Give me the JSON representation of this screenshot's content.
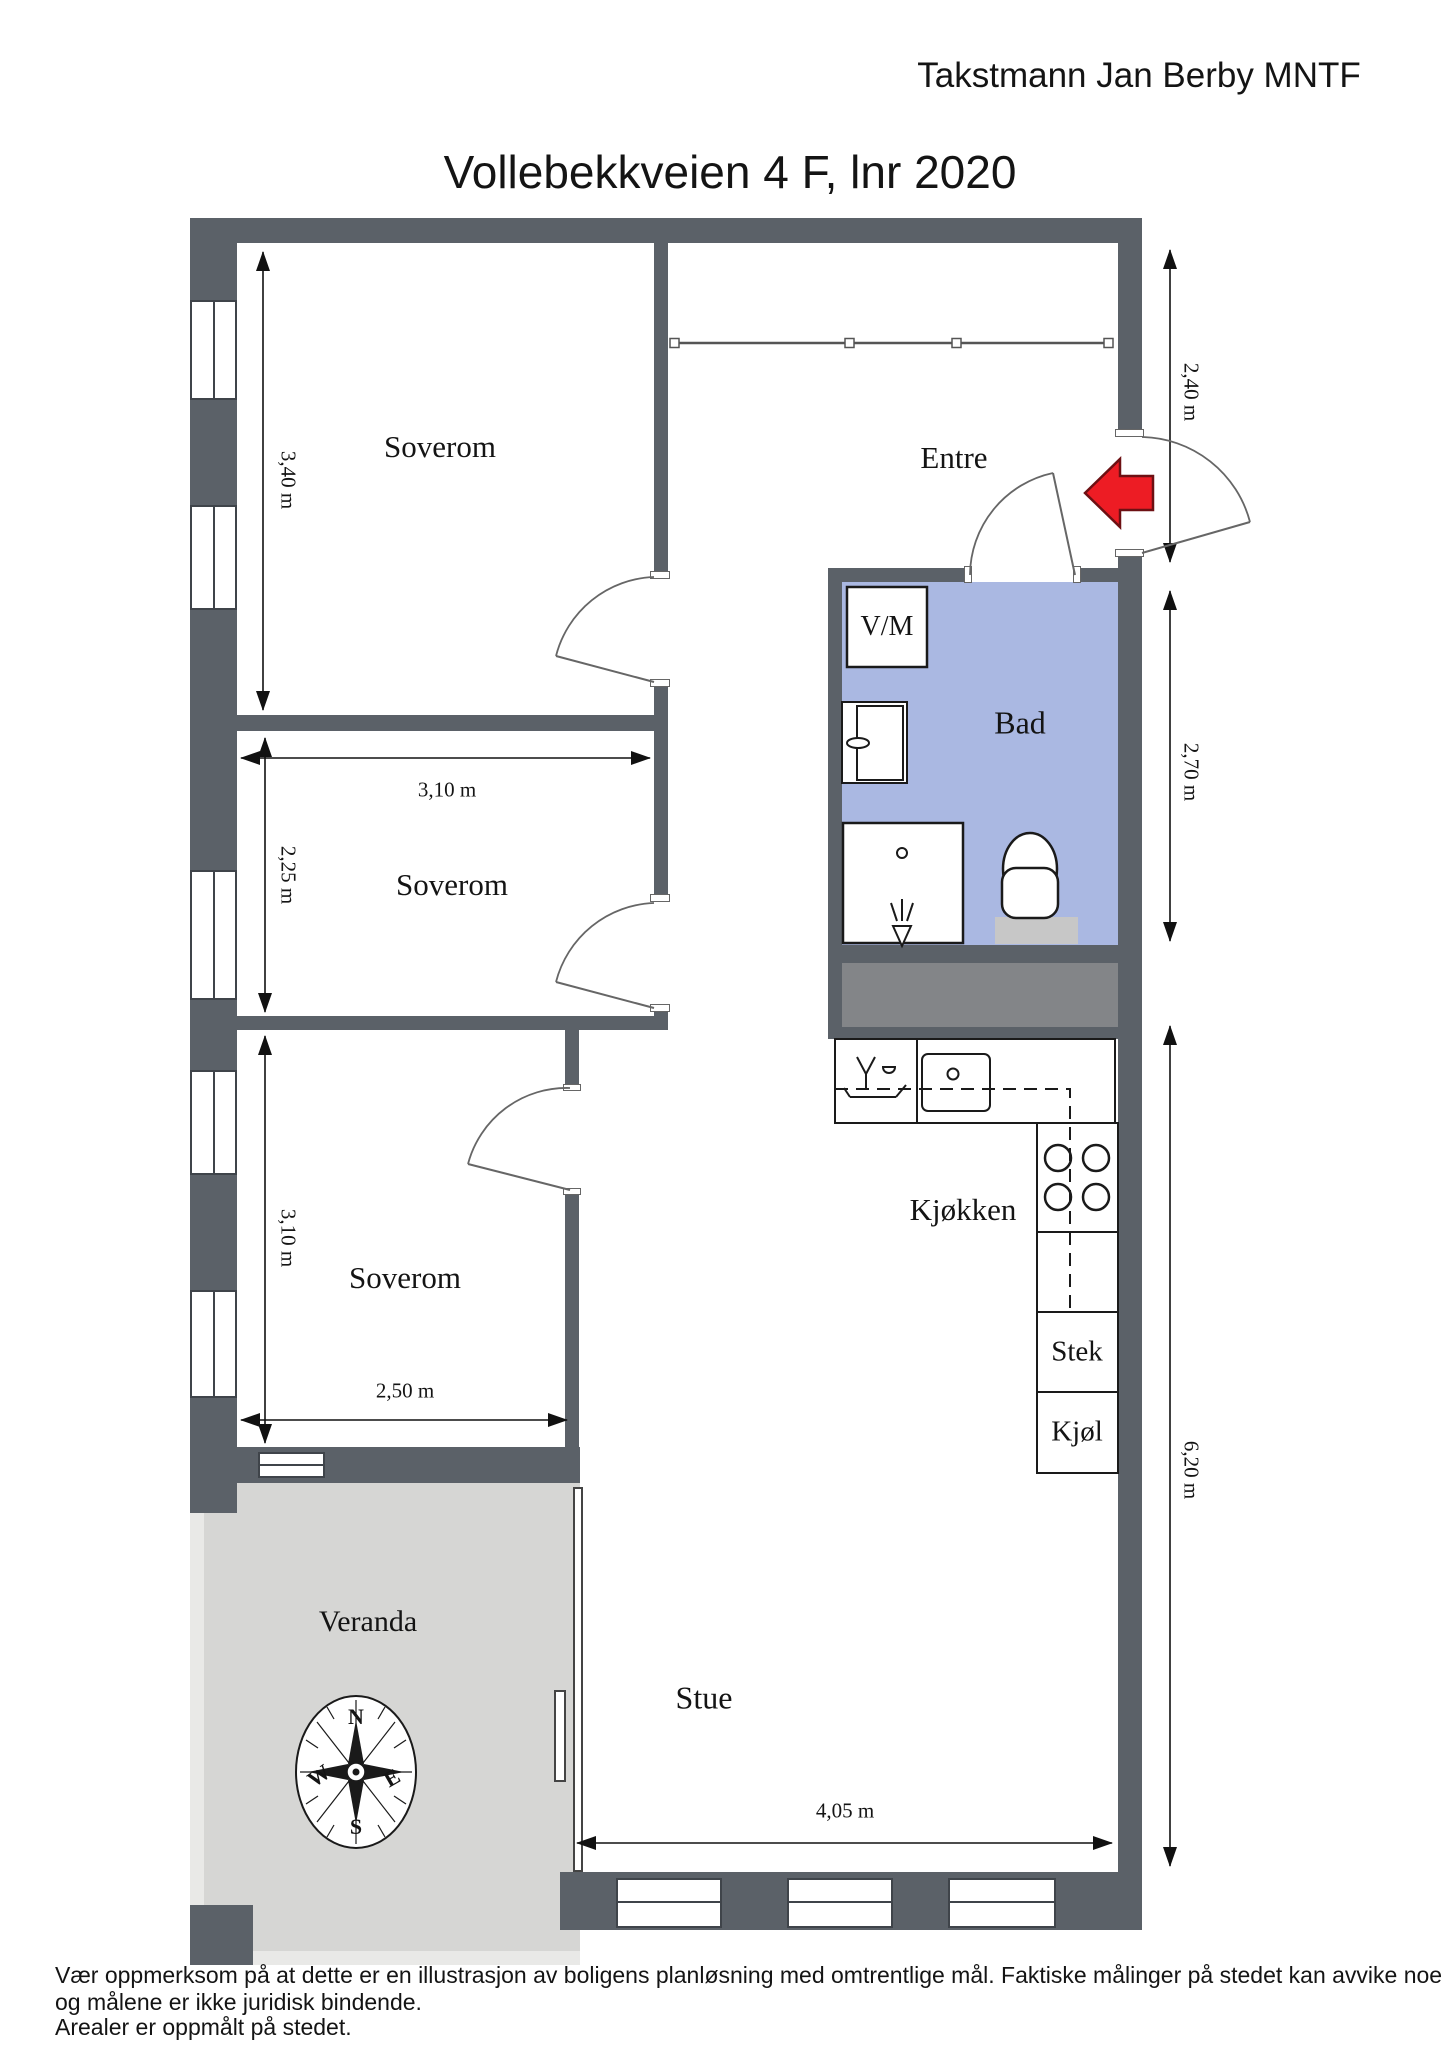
{
  "header": {
    "appraiser": "Takstmann Jan Berby MNTF",
    "title": "Vollebekkveien 4 F, lnr 2020"
  },
  "rooms": {
    "soverom1": "Soverom",
    "soverom2": "Soverom",
    "soverom3": "Soverom",
    "entre": "Entre",
    "bad": "Bad",
    "kjokken": "Kjøkken",
    "stue": "Stue",
    "veranda": "Veranda"
  },
  "fixtures": {
    "washing_machine": "V/M",
    "oven": "Stek",
    "fridge": "Kjøl"
  },
  "dimensions": {
    "bedroom1_height": "3,40 m",
    "bedroom2_width": "3,10 m",
    "bedroom2_height": "2,25 m",
    "bedroom3_height": "3,10 m",
    "bedroom3_width": "2,50 m",
    "entre_depth": "2,40 m",
    "bad_depth": "2,70 m",
    "living_depth": "6,20 m",
    "stue_width": "4,05 m"
  },
  "compass": {
    "n": "N",
    "e": "E",
    "s": "S",
    "w": "W"
  },
  "disclaimer": {
    "line1": "Vær oppmerksom på at dette er en illustrasjon av boligens planløsning med omtrentlige mål. Faktiske målinger på stedet kan avvike noe",
    "line2": "og målene er ikke juridisk bindende.",
    "line3": "Arealer er oppmålt på stedet."
  },
  "colors": {
    "wall": "#5b6168",
    "bad_floor": "#aab8e2",
    "veranda_floor": "#d6d6d4",
    "veranda_border": "#e9e9e7",
    "closet_fill": "#838588",
    "toilet_mat": "#c7c7c7",
    "arrow_red": "#ed1c24"
  }
}
